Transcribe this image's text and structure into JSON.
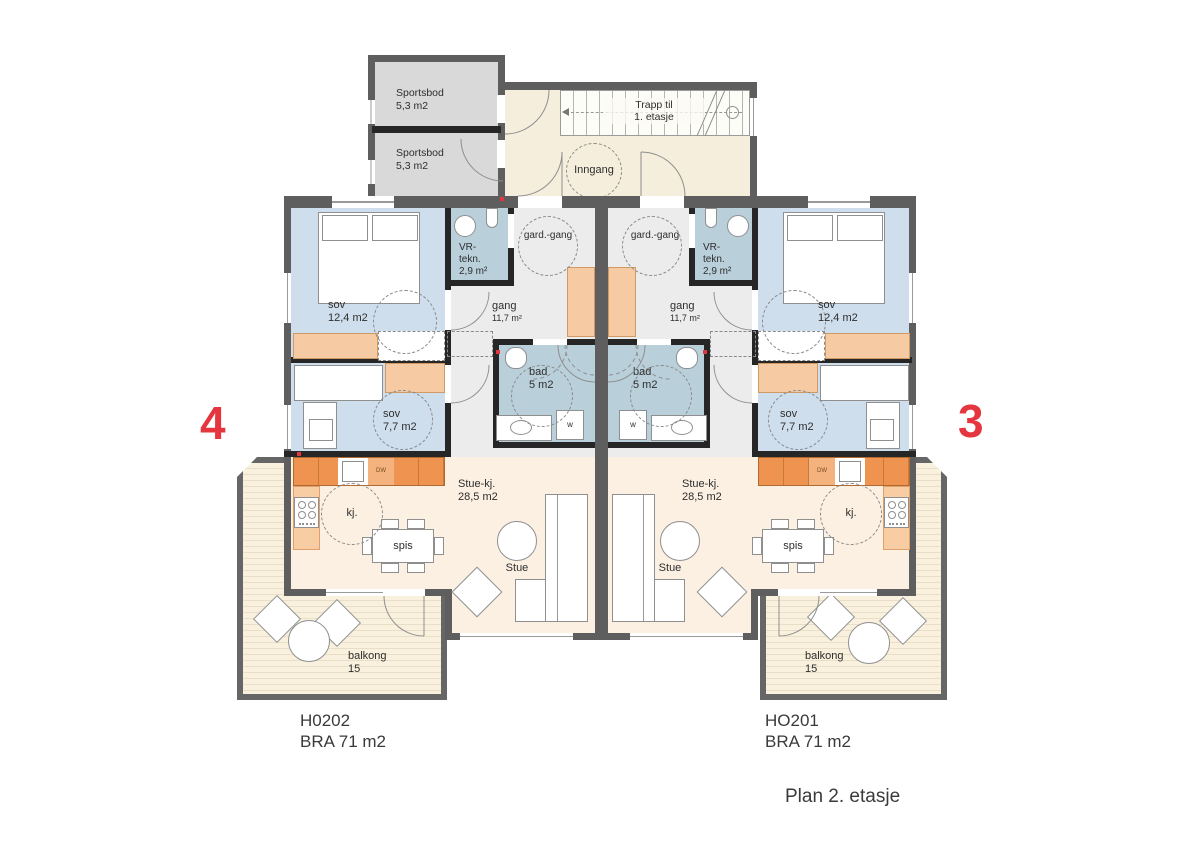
{
  "title": "Plan 2. etasje",
  "colors": {
    "wall": "#5e5e5e",
    "accent_red": "#e5353f",
    "bedroom": "#cfdeed",
    "wet_room": "#b9cfda",
    "hall": "#ececec",
    "living": "#fbf0e2",
    "counter_orange": "#ef9450",
    "closet_peach": "#f6caa3",
    "storage_gray": "#d9d9d9",
    "entry_cream": "#f6eedc"
  },
  "storage": {
    "room1": {
      "name": "Sportsbod",
      "area": "5,3 m2"
    },
    "room2": {
      "name": "Sportsbod",
      "area": "5,3 m2"
    }
  },
  "stair": {
    "line1": "Trapp til",
    "line2": "1. etasje"
  },
  "entrance_label": "Inngang",
  "units": {
    "left": {
      "marker": "4",
      "id": "H0202",
      "bra": "BRA 71 m2",
      "sov_large": {
        "name": "sov",
        "area": "12,4 m2"
      },
      "sov_small": {
        "name": "sov",
        "area": "7,7 m2"
      },
      "vr": {
        "line1": "VR-",
        "line2": "tekn.",
        "area": "2,9 m²"
      },
      "gard": "gard.-gang",
      "gang": {
        "name": "gang",
        "area": "11,7 m²"
      },
      "bad": {
        "name": "bad",
        "area": "5 m2"
      },
      "stue_kj": {
        "name": "Stue-kj.",
        "area": "28,5 m2"
      },
      "kj": "kj.",
      "spis": "spis",
      "stue": "Stue",
      "dw": "DW",
      "washer": "w",
      "balcony": {
        "name": "balkong",
        "area": "15"
      }
    },
    "right": {
      "marker": "3",
      "id": "HO201",
      "bra": "BRA 71 m2",
      "sov_large": {
        "name": "sov",
        "area": "12,4 m2"
      },
      "sov_small": {
        "name": "sov",
        "area": "7,7 m2"
      },
      "vr": {
        "line1": "VR-",
        "line2": "tekn.",
        "area": "2,9 m²"
      },
      "gard": "gard.-gang",
      "gang": {
        "name": "gang",
        "area": "11,7 m²"
      },
      "bad": {
        "name": "bad",
        "area": "5 m2"
      },
      "stue_kj": {
        "name": "Stue-kj.",
        "area": "28,5 m2"
      },
      "kj": "kj.",
      "spis": "spis",
      "stue": "Stue",
      "dw": "DW",
      "washer": "w",
      "balcony": {
        "name": "balkong",
        "area": "15"
      }
    }
  }
}
